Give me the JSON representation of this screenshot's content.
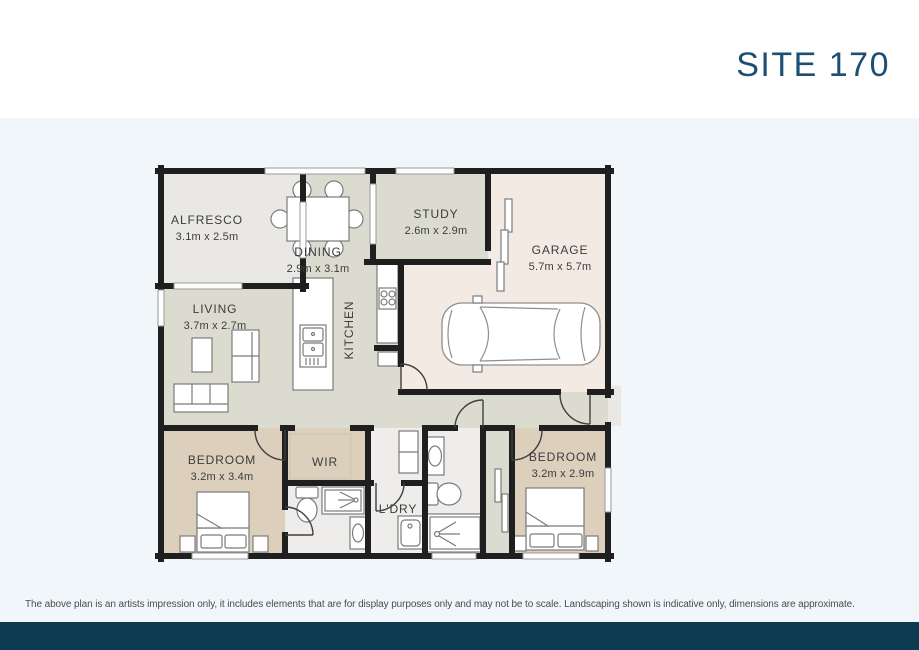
{
  "header": {
    "title": "SITE 170"
  },
  "plan": {
    "rooms": [
      {
        "id": "alfresco",
        "name": "ALFRESCO",
        "dims": "3.1m x 2.5m"
      },
      {
        "id": "dining",
        "name": "DINING",
        "dims": "2.9m x 3.1m"
      },
      {
        "id": "study",
        "name": "STUDY",
        "dims": "2.6m x 2.9m"
      },
      {
        "id": "garage",
        "name": "GARAGE",
        "dims": "5.7m x 5.7m"
      },
      {
        "id": "living",
        "name": "LIVING",
        "dims": "3.7m x 2.7m"
      },
      {
        "id": "kitchen",
        "name": "KITCHEN",
        "dims": ""
      },
      {
        "id": "bedroom-1",
        "name": "BEDROOM",
        "dims": "3.2m x 3.4m"
      },
      {
        "id": "wir",
        "name": "WIR",
        "dims": ""
      },
      {
        "id": "ldry",
        "name": "L'DRY",
        "dims": ""
      },
      {
        "id": "bedroom-2",
        "name": "BEDROOM",
        "dims": "3.2m x 2.9m"
      }
    ],
    "colors": {
      "wall": "#1f1f1f",
      "label": "#3c3c3c",
      "floor_main": "#dcdbd0",
      "floor_alfresco": "#e9e8e4",
      "floor_garage": "#f3eae4",
      "floor_bedroom": "#dccfbc",
      "floor_wet": "#eeedeb"
    }
  },
  "footer": {
    "disclaimer": "The above plan is an artists impression only, it includes elements that are for display purposes only and may not be to scale. Landscaping shown is indicative only, dimensions are approximate.",
    "bar_color": "#0d3c52"
  },
  "theme": {
    "title_color": "#1d4f73",
    "page_background": "#f0f6f9"
  }
}
